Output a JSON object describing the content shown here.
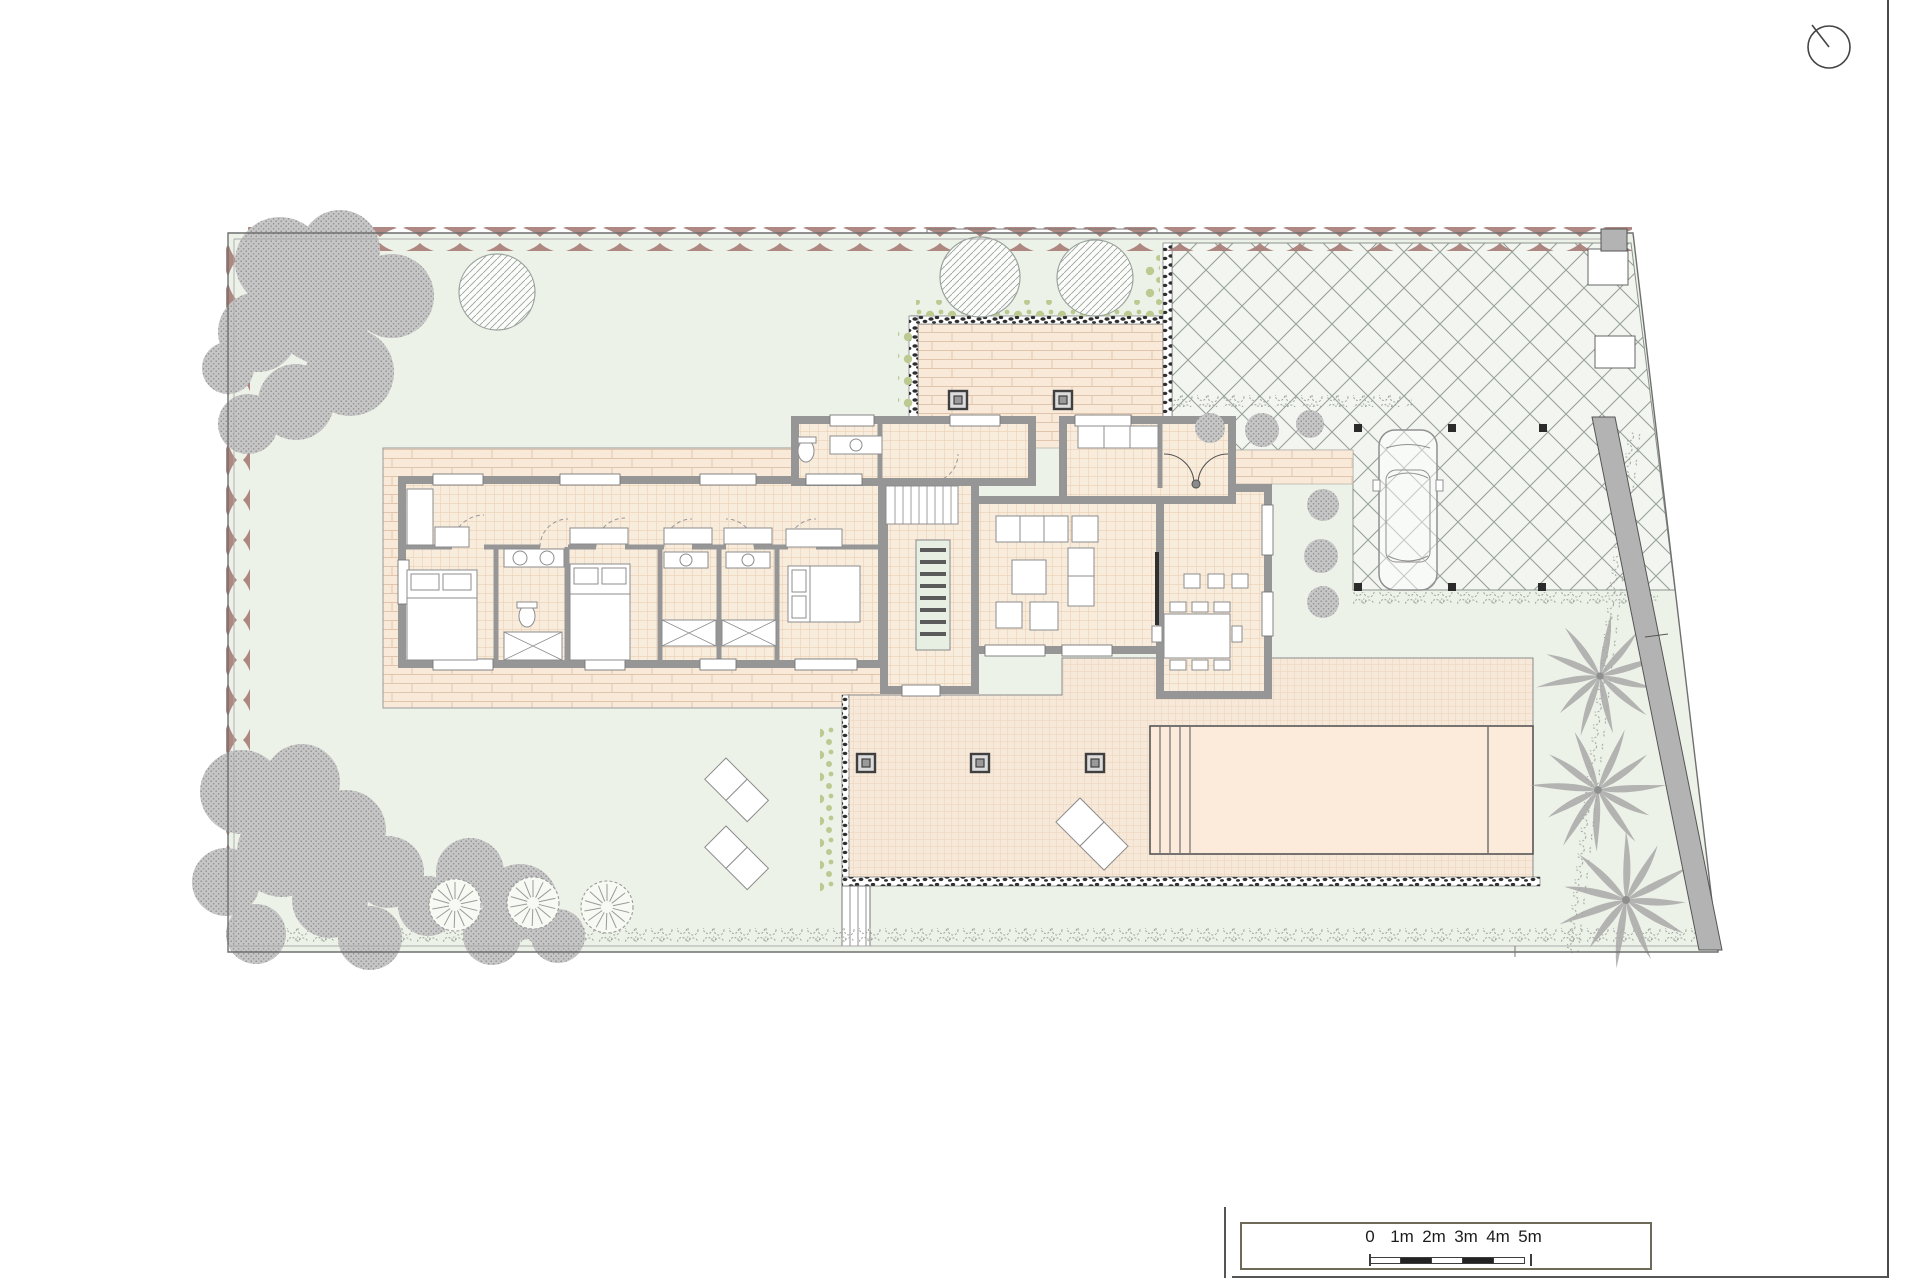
{
  "scale_bar": {
    "labels": [
      "0",
      "1m",
      "2m",
      "3m",
      "4m",
      "5m"
    ],
    "total_meters": 5,
    "segment_meters": 1
  },
  "north_indicator": {
    "icon": "compass-circle-with-needle"
  },
  "colors": {
    "lawn": "#edf2e9",
    "hedge": "#a87b76",
    "treegray": "#c6c6c6",
    "treedot": "#8f8f8f",
    "hatchline": "#9aa49d",
    "crossbg": "#f3f6f0",
    "crossline": "#97a19a",
    "brickbg": "#f8e9d9",
    "brickline": "#e0c4ac",
    "tilebg": "#f8ecdd",
    "tileline": "#eed4ba",
    "terrbg": "#f7e9d9",
    "terrline": "#efd6bd",
    "wall": "#969696",
    "pool": "#fcebdb",
    "pebble": "#2f2f2f",
    "shrub": "#bcca92",
    "furn": "#8c8c8c",
    "line": "#6f6f6f",
    "scrub": "#9aa29a",
    "scaleborder": "#6d6a57",
    "text": "#1c1c1c",
    "stairwell": "#e7efe3",
    "wallfill": "#b3b3b3"
  }
}
